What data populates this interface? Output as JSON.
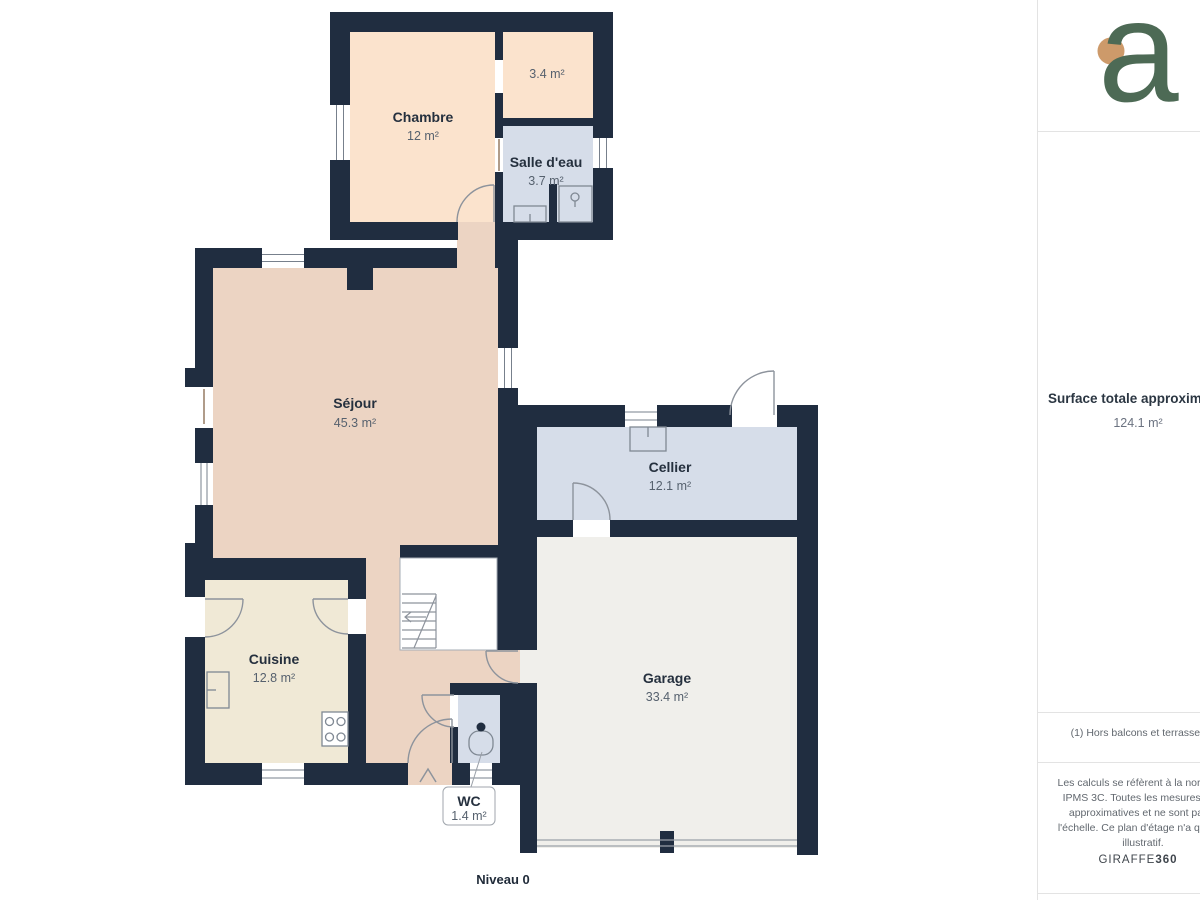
{
  "plan": {
    "level_label": "Niveau 0",
    "rooms": {
      "chambre": {
        "name": "Chambre",
        "area": "12 m²"
      },
      "degagement": {
        "area": "3.4 m²"
      },
      "salle_eau": {
        "name": "Salle d'eau",
        "area": "3.7 m²"
      },
      "sejour": {
        "name": "Séjour",
        "area": "45.3 m²"
      },
      "cellier": {
        "name": "Cellier",
        "area": "12.1 m²"
      },
      "cuisine": {
        "name": "Cuisine",
        "area": "12.8 m²"
      },
      "garage": {
        "name": "Garage",
        "area": "33.4 m²"
      },
      "wc": {
        "name": "WC",
        "area": "1.4 m²"
      }
    },
    "colors": {
      "wall": "#202d40",
      "room_warm_light": "#fbe3cd",
      "room_warm": "#ecd4c3",
      "room_wet": "#d6dde9",
      "room_kitchen": "#f0e9d6",
      "room_garage": "#f0efeb"
    }
  },
  "sidebar": {
    "logo_letter": "a",
    "logo_colors": {
      "letter": "#4d6a55",
      "dot": "#cd9a6a"
    },
    "surface_title": "Surface totale approximati",
    "surface_value": "124.1 m²",
    "note": "(1) Hors balcons et terrasses",
    "disclaimer_lines": [
      "Les calculs se réfèrent à la norme RI",
      "IPMS 3C. Toutes les mesures sont",
      "approximatives et ne sont pas à",
      "l'échelle. Ce plan d'étage n'a qu'un b",
      "illustratif."
    ],
    "brand_name": "GIRAFFE",
    "brand_suffix": "360"
  }
}
